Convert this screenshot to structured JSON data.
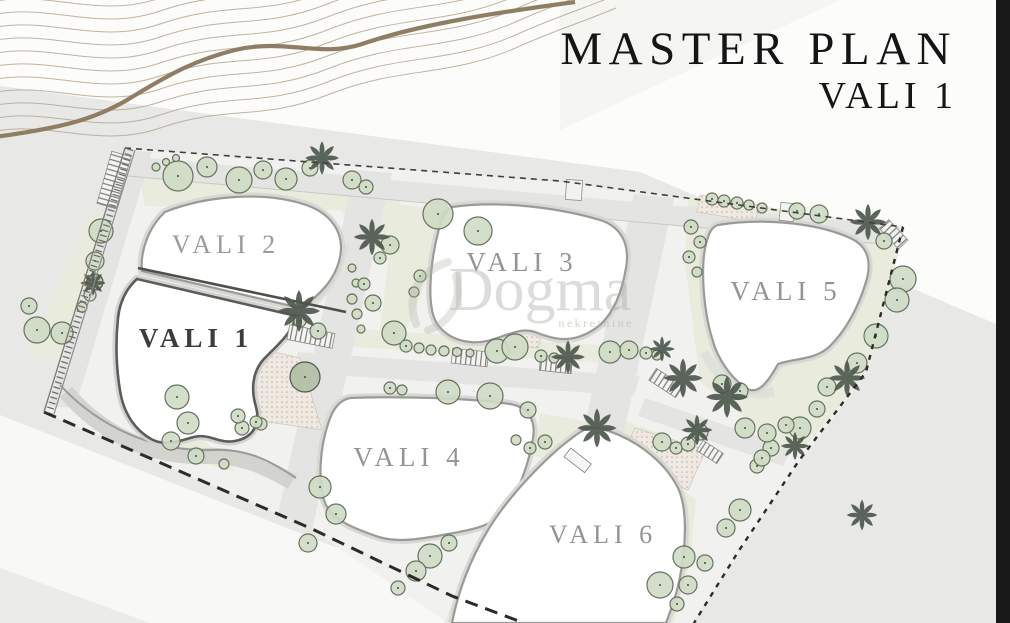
{
  "title": {
    "main": "MASTER PLAN",
    "sub": "VALI 1"
  },
  "watermark": {
    "brand": "Dogma",
    "tagline": "nekretnine"
  },
  "plots": [
    {
      "label": "VALI 1",
      "emphasis": true
    },
    {
      "label": "VALI 2",
      "emphasis": false
    },
    {
      "label": "VALI 3",
      "emphasis": false
    },
    {
      "label": "VALI 4",
      "emphasis": false
    },
    {
      "label": "VALI 5",
      "emphasis": false
    },
    {
      "label": "VALI 6",
      "emphasis": false
    }
  ],
  "colors": {
    "background": "#e8e8e7",
    "contour_accent": "#8f7e64",
    "plot_outline": "#9a9a97",
    "label_muted": "#949492",
    "label_dark": "#3c3c3a",
    "tree_fill": "#cfdbc5",
    "edge_bar": "#191919"
  }
}
